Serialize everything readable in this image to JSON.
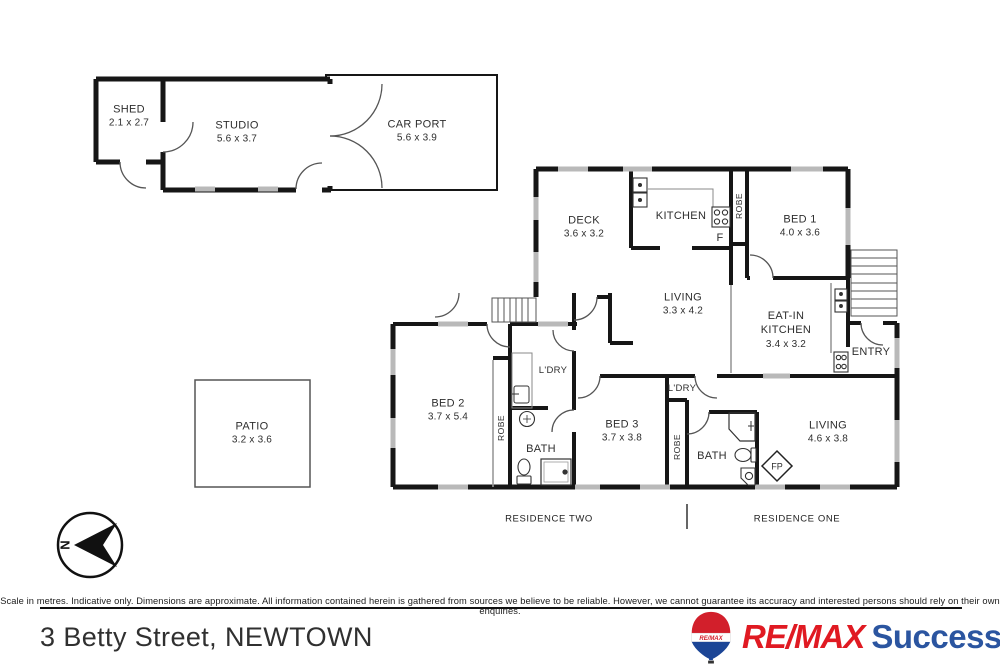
{
  "address": "3 Betty Street, NEWTOWN",
  "disclaimer": "Scale in metres. Indicative only. Dimensions are approximate. All information contained herein is gathered from sources we believe to be reliable. However, we cannot guarantee its accuracy and interested persons should rely on their own enquiries.",
  "compass": {
    "north_label": "N"
  },
  "branding": {
    "name": "RE/MAX",
    "suffix": "Success",
    "balloon_text": "RE/MAX",
    "red": "#e01a22",
    "blue": "#1b4596"
  },
  "sections": {
    "residence_two": "RESIDENCE TWO",
    "residence_one": "RESIDENCE ONE"
  },
  "rooms": {
    "shed": {
      "name": "SHED",
      "dims": "2.1 x 2.7"
    },
    "studio": {
      "name": "STUDIO",
      "dims": "5.6 x 3.7"
    },
    "carport": {
      "name": "CAR PORT",
      "dims": "5.6 x 3.9"
    },
    "deck": {
      "name": "DECK",
      "dims": "3.6 x 3.2"
    },
    "kitchen": {
      "name": "KITCHEN"
    },
    "fridge": {
      "name": "F"
    },
    "robe_bed1": {
      "name": "ROBE"
    },
    "bed1": {
      "name": "BED 1",
      "dims": "4.0 x 3.6"
    },
    "living_a": {
      "name": "LIVING",
      "dims": "3.3 x 4.2"
    },
    "eat_in_kitchen": {
      "name": "EAT-IN KITCHEN",
      "dims": "3.4 x 3.2"
    },
    "entry": {
      "name": "ENTRY"
    },
    "bed2": {
      "name": "BED 2",
      "dims": "3.7 x 5.4"
    },
    "robe_bed2": {
      "name": "ROBE"
    },
    "laundry_res2": {
      "name": "L'DRY"
    },
    "bath_res2": {
      "name": "BATH"
    },
    "bed3": {
      "name": "BED 3",
      "dims": "3.7 x 3.8"
    },
    "laundry_res1": {
      "name": "L'DRY"
    },
    "robe_bed3": {
      "name": "ROBE"
    },
    "bath_res1": {
      "name": "BATH"
    },
    "fireplace": {
      "name": "FP"
    },
    "living_b": {
      "name": "LIVING",
      "dims": "4.6 x 3.8"
    },
    "patio": {
      "name": "PATIO",
      "dims": "3.2 x 3.6"
    }
  }
}
